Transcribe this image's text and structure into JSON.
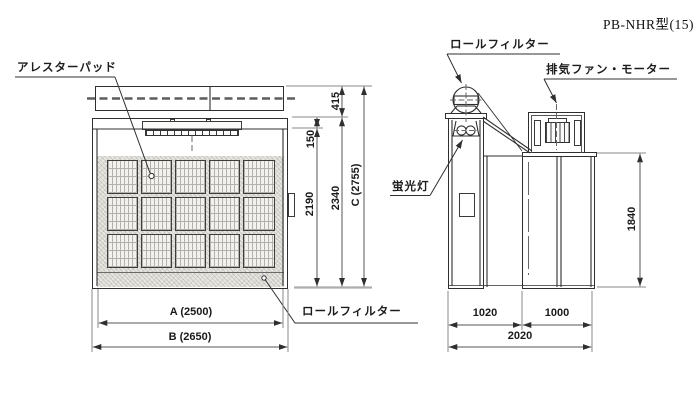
{
  "title": "PB-NHR型(15)",
  "front_view": {
    "labels": {
      "arrester_pad": "アレスターパッド",
      "roll_filter": "ロールフィルター"
    },
    "dimensions": {
      "duct_height": "415",
      "lamp_band": "150",
      "opening_height": "2190",
      "body_height": "2340",
      "total_height": "C (2755)",
      "opening_width": "A (2500)",
      "total_width": "B (2650)"
    }
  },
  "side_view": {
    "labels": {
      "roll_filter": "ロールフィルター",
      "exhaust_fan_motor": "排気ファン・モーター",
      "fluorescent_lamp": "蛍光灯"
    },
    "dimensions": {
      "booth_height": "1840",
      "front_depth": "1020",
      "rear_depth": "1000",
      "total_depth": "2020"
    }
  },
  "colors": {
    "object_line": "#2f2f2f",
    "dimension_line": "#8a8a8a",
    "hatch_fill": "#e8e7e2"
  }
}
